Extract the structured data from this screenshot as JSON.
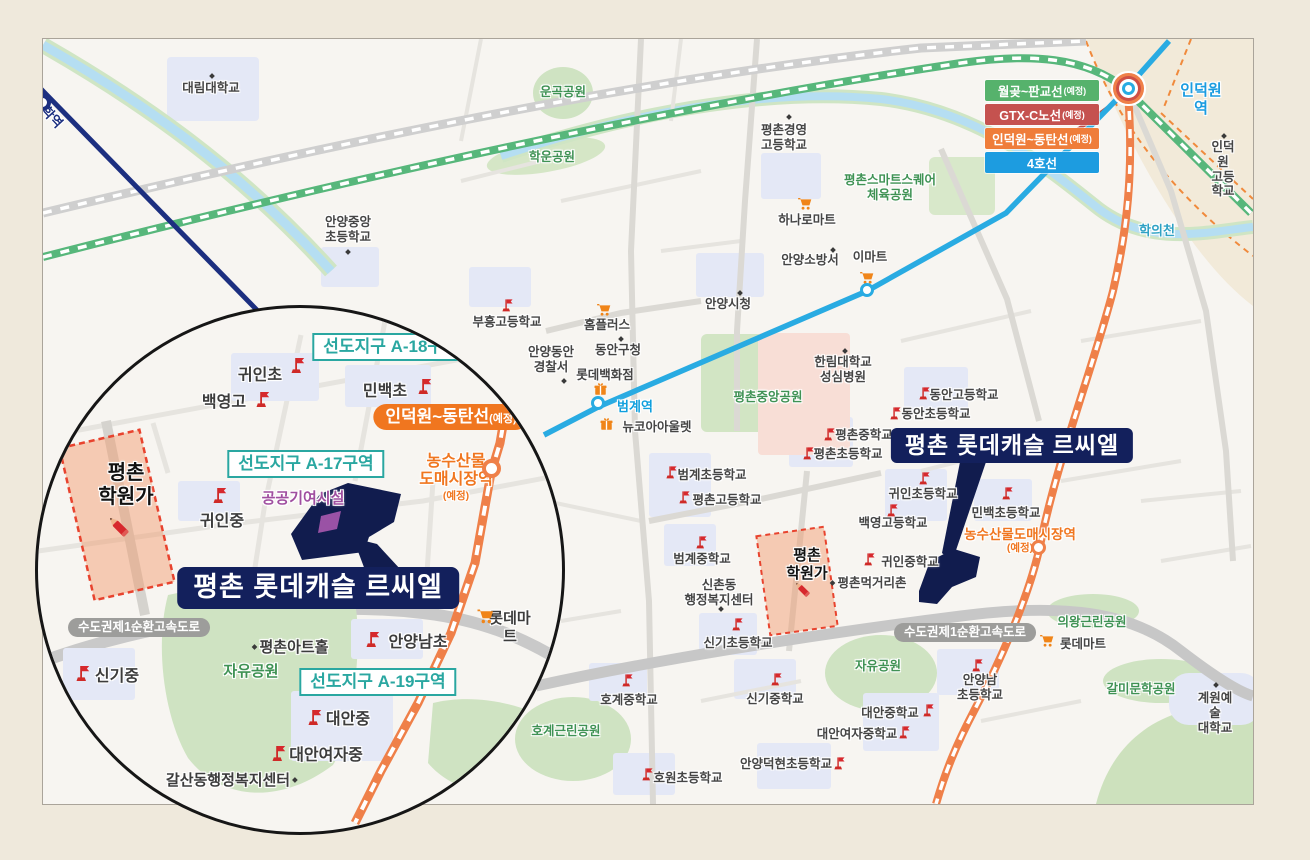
{
  "project": {
    "name": "평촌 롯데캐슬 르씨엘"
  },
  "legend": {
    "items": [
      {
        "id": "line-wolgot-pangyo",
        "label": "월곶~판교선",
        "note": "(예정)",
        "color": "#56b26c"
      },
      {
        "id": "line-gtx-c",
        "label": "GTX-C노선",
        "note": "(예정)",
        "color": "#c5524f"
      },
      {
        "id": "line-indeogwon-dongtan",
        "label": "인덕원~동탄선",
        "note": "(예정)",
        "color": "#ef7d3a"
      },
      {
        "id": "line-4",
        "label": "4호선",
        "note": "",
        "color": "#1d9ce0"
      }
    ]
  },
  "colors": {
    "line4_cyan": "#29abe2",
    "line1_navy": "#1c2f80",
    "rail_green": "#57b77b",
    "rail_orange": "#ef8049",
    "gtx_red": "#bd4d49",
    "park_green_text": "#3f9254",
    "teal_district": "#2aa7a1",
    "orange_planned": "#f0761f",
    "navy_label": "#13205c",
    "school_flag_red": "#d7282d",
    "hakwon_dashed_red": "#e8432e",
    "purple_facility": "#a04fa0"
  },
  "icon_names": [
    "school-flag-icon",
    "mart-cart-icon",
    "department-gift-icon",
    "hakwon-pencil-icon",
    "poi-dot-icon",
    "station-marker"
  ],
  "map_labels": [
    {
      "id": "daelim-univ",
      "layer": "m",
      "cls": "g",
      "x": 210,
      "y": 80,
      "text": "대림대학교"
    },
    {
      "id": "anyang-jungang-elem",
      "layer": "m",
      "cls": "g",
      "x": 347,
      "y": 214,
      "text": "안양중앙",
      "text2": "초등학교"
    },
    {
      "id": "myeonghak-station",
      "layer": "m",
      "cls": "navyrot",
      "x": 47,
      "y": 104,
      "text": "명학역"
    },
    {
      "id": "ungok-park",
      "layer": "m",
      "cls": "park",
      "x": 562,
      "y": 84,
      "text": "운곡공원"
    },
    {
      "id": "hakun-park",
      "layer": "m",
      "cls": "park",
      "x": 551,
      "y": 149,
      "text": "학운공원"
    },
    {
      "id": "pc-gyeongyeong-high",
      "layer": "m",
      "cls": "g",
      "x": 783,
      "y": 122,
      "text": "평촌경영",
      "text2": "고등학교"
    },
    {
      "id": "pc-smartsquare-park",
      "layer": "m",
      "cls": "park",
      "x": 889,
      "y": 172,
      "text": "평촌스마트스퀘어",
      "text2": "체육공원"
    },
    {
      "id": "hanaro-mart",
      "layer": "m",
      "cls": "g",
      "x": 806,
      "y": 212,
      "text": "하나로마트"
    },
    {
      "id": "anyang-fire-station",
      "layer": "m",
      "cls": "g",
      "x": 809,
      "y": 252,
      "text": "안양소방서"
    },
    {
      "id": "emart",
      "layer": "m",
      "cls": "g",
      "x": 869,
      "y": 249,
      "text": "이마트"
    },
    {
      "id": "anyang-cityhall",
      "layer": "m",
      "cls": "g",
      "x": 727,
      "y": 296,
      "text": "안양시청"
    },
    {
      "id": "homeplus",
      "layer": "m",
      "cls": "g",
      "x": 606,
      "y": 317,
      "text": "홈플러스"
    },
    {
      "id": "dongan-guoffice",
      "layer": "m",
      "cls": "g",
      "x": 617,
      "y": 342,
      "text": "동안구청"
    },
    {
      "id": "anyang-dongan-police",
      "layer": "m",
      "cls": "g",
      "x": 550,
      "y": 344,
      "text": "안양동안",
      "text2": "경찰서"
    },
    {
      "id": "lotte-dept",
      "layer": "m",
      "cls": "g",
      "x": 604,
      "y": 367,
      "text": "롯데백화점"
    },
    {
      "id": "beomgye-station-label",
      "layer": "m",
      "cls": "cyan",
      "x": 634,
      "y": 398,
      "text": "범계역"
    },
    {
      "id": "newcore-outlet",
      "layer": "m",
      "cls": "g",
      "x": 656,
      "y": 419,
      "text": "뉴코아아울렛"
    },
    {
      "id": "hallym-hospital",
      "layer": "m",
      "cls": "g",
      "x": 842,
      "y": 354,
      "text": "한림대학교",
      "text2": "성심병원"
    },
    {
      "id": "pc-central-park",
      "layer": "m",
      "cls": "park",
      "x": 767,
      "y": 389,
      "text": "평촌중앙공원"
    },
    {
      "id": "buheung-high",
      "layer": "m",
      "cls": "g",
      "x": 506,
      "y": 314,
      "text": "부흥고등학교"
    },
    {
      "id": "dongan-high",
      "layer": "m",
      "cls": "g",
      "x": 963,
      "y": 387,
      "text": "동안고등학교"
    },
    {
      "id": "dongan-elem",
      "layer": "m",
      "cls": "g",
      "x": 935,
      "y": 406,
      "text": "동안초등학교"
    },
    {
      "id": "pyeongchon-middle",
      "layer": "m",
      "cls": "g",
      "x": 863,
      "y": 427,
      "text": "평촌중학교"
    },
    {
      "id": "pyeongchon-elem",
      "layer": "m",
      "cls": "g",
      "x": 847,
      "y": 446,
      "text": "평촌초등학교"
    },
    {
      "id": "guin-elem-main",
      "layer": "m",
      "cls": "g",
      "x": 922,
      "y": 486,
      "text": "귀인초등학교"
    },
    {
      "id": "minbaek-elem-main",
      "layer": "m",
      "cls": "g",
      "x": 1005,
      "y": 505,
      "text": "민백초등학교"
    },
    {
      "id": "baekyeong-high-main",
      "layer": "m",
      "cls": "g",
      "x": 892,
      "y": 515,
      "text": "백영고등학교"
    },
    {
      "id": "guin-middle-main",
      "layer": "m",
      "cls": "g",
      "x": 909,
      "y": 554,
      "text": "귀인중학교"
    },
    {
      "id": "pc-meokgeori",
      "layer": "m",
      "cls": "g",
      "x": 866,
      "y": 575,
      "text": "평촌먹거리촌",
      "dot": "l"
    },
    {
      "id": "beomgye-elem",
      "layer": "m",
      "cls": "g",
      "x": 711,
      "y": 467,
      "text": "범계초등학교"
    },
    {
      "id": "pyeongchon-high",
      "layer": "m",
      "cls": "g",
      "x": 726,
      "y": 492,
      "text": "평촌고등학교"
    },
    {
      "id": "beomgye-middle",
      "layer": "m",
      "cls": "g",
      "x": 701,
      "y": 551,
      "text": "범계중학교"
    },
    {
      "id": "sinchon-center",
      "layer": "m",
      "cls": "g",
      "x": 718,
      "y": 577,
      "text": "신촌동",
      "text2": "행정복지센터"
    },
    {
      "id": "singi-elem",
      "layer": "m",
      "cls": "g",
      "x": 737,
      "y": 635,
      "text": "신기초등학교"
    },
    {
      "id": "hakwonga-main",
      "layer": "m",
      "cls": "hakwon",
      "x": 806,
      "y": 546,
      "text": "평촌",
      "text2": "학원가"
    },
    {
      "id": "hogye-middle",
      "layer": "m",
      "cls": "g",
      "x": 628,
      "y": 692,
      "text": "호계중학교"
    },
    {
      "id": "hogye-park",
      "layer": "m",
      "cls": "park",
      "x": 565,
      "y": 723,
      "text": "호계근린공원"
    },
    {
      "id": "singi-middle-main",
      "layer": "m",
      "cls": "g",
      "x": 774,
      "y": 691,
      "text": "신기중학교"
    },
    {
      "id": "jayu-park-main",
      "layer": "m",
      "cls": "park",
      "x": 877,
      "y": 658,
      "text": "자유공원"
    },
    {
      "id": "daean-middle-main",
      "layer": "m",
      "cls": "g",
      "x": 889,
      "y": 705,
      "text": "대안중학교"
    },
    {
      "id": "daean-girls-main",
      "layer": "m",
      "cls": "g",
      "x": 856,
      "y": 726,
      "text": "대안여자중학교"
    },
    {
      "id": "anyangnam-elem-main",
      "layer": "m",
      "cls": "g",
      "x": 979,
      "y": 672,
      "text": "안양남",
      "text2": "초등학교"
    },
    {
      "id": "anyang-deokhyeon-elem",
      "layer": "m",
      "cls": "g",
      "x": 785,
      "y": 756,
      "text": "안양덕현초등학교"
    },
    {
      "id": "howon-elem",
      "layer": "m",
      "cls": "g",
      "x": 687,
      "y": 770,
      "text": "호원초등학교"
    },
    {
      "id": "uiwang-park",
      "layer": "m",
      "cls": "park",
      "x": 1091,
      "y": 614,
      "text": "의왕근린공원"
    },
    {
      "id": "lottemart-main",
      "layer": "m",
      "cls": "g",
      "x": 1082,
      "y": 636,
      "text": "롯데마트"
    },
    {
      "id": "galmi-park",
      "layer": "m",
      "cls": "park",
      "x": 1140,
      "y": 681,
      "text": "갈미문학공원"
    },
    {
      "id": "kaywon-univ",
      "layer": "m",
      "cls": "g",
      "x": 1214,
      "y": 690,
      "text": "계원예술",
      "text2": "대학교"
    },
    {
      "id": "ring-expressway-main",
      "layer": "m",
      "cls": "pill",
      "x": 964,
      "y": 622,
      "text": "수도권제1순환고속도로"
    },
    {
      "id": "hakuicheon",
      "layer": "m",
      "cls": "stream",
      "x": 1156,
      "y": 222,
      "text": "학의천"
    },
    {
      "id": "indeogwon-station-label",
      "layer": "m",
      "cls": "cyanb",
      "x": 1200,
      "y": 81,
      "text": "인덕원역"
    },
    {
      "id": "indeogwon-high",
      "layer": "m",
      "cls": "g",
      "x": 1222,
      "y": 139,
      "text": "인덕원",
      "text2": "고등학교"
    },
    {
      "id": "nongsusanmul-station-main",
      "layer": "m",
      "cls": "orangeT",
      "x": 1019,
      "y": 526,
      "text": "농수산물도매시장역"
    },
    {
      "id": "nongsusanmul-note-main",
      "layer": "m",
      "cls": "orangeS",
      "x": 1019,
      "y": 541,
      "text": "(예정)"
    },
    {
      "id": "project-label-main",
      "layer": "m",
      "cls": "navybox",
      "x": 1011,
      "y": 427,
      "text": "평촌 롯데캐슬 르씨엘"
    },
    {
      "id": "district-a18",
      "layer": "i",
      "cls": "tealbox",
      "x": 388,
      "y": 330,
      "text": "선도지구 A-18구역"
    },
    {
      "id": "guin-elem-inset",
      "layer": "i",
      "cls": "schoolb",
      "x": 257,
      "y": 364,
      "text": "귀인초"
    },
    {
      "id": "baekyeong-high-inset",
      "layer": "i",
      "cls": "schoolb",
      "x": 221,
      "y": 391,
      "text": "백영고"
    },
    {
      "id": "minbaek-elem-inset",
      "layer": "i",
      "cls": "schoolb",
      "x": 382,
      "y": 380,
      "text": "민백초"
    },
    {
      "id": "indeogwon-dongtan-pill",
      "layer": "i",
      "cls": "orangepill",
      "x": 448,
      "y": 401,
      "text": "인덕원~동탄선",
      "note": "(예정)"
    },
    {
      "id": "district-a17",
      "layer": "i",
      "cls": "tealbox",
      "x": 303,
      "y": 447,
      "text": "선도지구 A-17구역"
    },
    {
      "id": "public-facility",
      "layer": "i",
      "cls": "purple",
      "x": 300,
      "y": 487,
      "text": "공공기여시설"
    },
    {
      "id": "guin-middle-inset",
      "layer": "i",
      "cls": "schoolb",
      "x": 219,
      "y": 510,
      "text": "귀인중"
    },
    {
      "id": "nongsusanmul-station-inset",
      "layer": "i",
      "cls": "orangeB",
      "x": 453,
      "y": 450,
      "text": "농수산물",
      "text2": "도매시장역"
    },
    {
      "id": "nongsusanmul-note-inset",
      "layer": "i",
      "cls": "orangeS",
      "x": 453,
      "y": 487,
      "text": "(예정)"
    },
    {
      "id": "hakwonga-inset",
      "layer": "i",
      "cls": "hakwonb",
      "x": 123,
      "y": 458,
      "text": "평촌",
      "text2": "학원가"
    },
    {
      "id": "project-label-inset",
      "layer": "i",
      "cls": "navybox2",
      "x": 315,
      "y": 564,
      "text": "평촌 롯데캐슬 르씨엘"
    },
    {
      "id": "ring-expressway-inset",
      "layer": "i",
      "cls": "pill",
      "x": 136,
      "y": 615,
      "text": "수도권제1순환고속도로"
    },
    {
      "id": "pc-arthall",
      "layer": "i",
      "cls": "insetg",
      "x": 286,
      "y": 636,
      "text": "평촌아트홀",
      "dot": "l"
    },
    {
      "id": "jayu-park-inset",
      "layer": "i",
      "cls": "parkb",
      "x": 248,
      "y": 660,
      "text": "자유공원"
    },
    {
      "id": "anyangnam-elem-inset",
      "layer": "i",
      "cls": "schoolb",
      "x": 415,
      "y": 631,
      "text": "안양남초"
    },
    {
      "id": "district-a19",
      "layer": "i",
      "cls": "tealbox",
      "x": 375,
      "y": 665,
      "text": "선도지구 A-19구역"
    },
    {
      "id": "daean-middle-inset",
      "layer": "i",
      "cls": "schoolb",
      "x": 345,
      "y": 708,
      "text": "대안중"
    },
    {
      "id": "daean-girls-inset",
      "layer": "i",
      "cls": "schoolb",
      "x": 323,
      "y": 744,
      "text": "대안여자중"
    },
    {
      "id": "galsan-center",
      "layer": "i",
      "cls": "insetg",
      "x": 230,
      "y": 769,
      "text": "갈산동행정복지센터",
      "dot": "r"
    },
    {
      "id": "singi-middle-inset",
      "layer": "i",
      "cls": "schoolb",
      "x": 114,
      "y": 665,
      "text": "신기중"
    },
    {
      "id": "lottemart-inset",
      "layer": "i",
      "cls": "insetg",
      "x": 507,
      "y": 607,
      "text": "롯데마트"
    }
  ],
  "icons": [
    {
      "type": "flag",
      "layer": "m",
      "x": 497,
      "y": 296
    },
    {
      "type": "flag",
      "layer": "m",
      "x": 914,
      "y": 384
    },
    {
      "type": "flag",
      "layer": "m",
      "x": 885,
      "y": 404
    },
    {
      "type": "flag",
      "layer": "m",
      "x": 819,
      "y": 425
    },
    {
      "type": "flag",
      "layer": "m",
      "x": 798,
      "y": 444
    },
    {
      "type": "flag",
      "layer": "m",
      "x": 914,
      "y": 469
    },
    {
      "type": "flag",
      "layer": "m",
      "x": 997,
      "y": 484
    },
    {
      "type": "flag",
      "layer": "m",
      "x": 882,
      "y": 501
    },
    {
      "type": "flag",
      "layer": "m",
      "x": 859,
      "y": 550
    },
    {
      "type": "flag",
      "layer": "m",
      "x": 661,
      "y": 463
    },
    {
      "type": "flag",
      "layer": "m",
      "x": 674,
      "y": 488
    },
    {
      "type": "flag",
      "layer": "m",
      "x": 691,
      "y": 533
    },
    {
      "type": "flag",
      "layer": "m",
      "x": 727,
      "y": 615
    },
    {
      "type": "flag",
      "layer": "m",
      "x": 617,
      "y": 671
    },
    {
      "type": "flag",
      "layer": "m",
      "x": 766,
      "y": 670
    },
    {
      "type": "flag",
      "layer": "m",
      "x": 918,
      "y": 701
    },
    {
      "type": "flag",
      "layer": "m",
      "x": 894,
      "y": 723
    },
    {
      "type": "flag",
      "layer": "m",
      "x": 967,
      "y": 656
    },
    {
      "type": "flag",
      "layer": "m",
      "x": 829,
      "y": 754
    },
    {
      "type": "flag",
      "layer": "m",
      "x": 637,
      "y": 765
    },
    {
      "type": "flagb",
      "layer": "i",
      "x": 283,
      "y": 352
    },
    {
      "type": "flagb",
      "layer": "i",
      "x": 248,
      "y": 386
    },
    {
      "type": "flagb",
      "layer": "i",
      "x": 410,
      "y": 373
    },
    {
      "type": "flagb",
      "layer": "i",
      "x": 205,
      "y": 482
    },
    {
      "type": "flagb",
      "layer": "i",
      "x": 358,
      "y": 626
    },
    {
      "type": "flagb",
      "layer": "i",
      "x": 300,
      "y": 704
    },
    {
      "type": "flagb",
      "layer": "i",
      "x": 264,
      "y": 740
    },
    {
      "type": "flagb",
      "layer": "i",
      "x": 68,
      "y": 660
    },
    {
      "type": "cart",
      "layer": "m",
      "x": 795,
      "y": 194
    },
    {
      "type": "cart",
      "layer": "m",
      "x": 857,
      "y": 268
    },
    {
      "type": "cart",
      "layer": "m",
      "x": 594,
      "y": 300
    },
    {
      "type": "cart",
      "layer": "m",
      "x": 1037,
      "y": 631
    },
    {
      "type": "cartb",
      "layer": "i",
      "x": 472,
      "y": 603
    },
    {
      "type": "gift",
      "layer": "m",
      "x": 592,
      "y": 381
    },
    {
      "type": "gift",
      "layer": "m",
      "x": 598,
      "y": 416
    },
    {
      "type": "pencil",
      "layer": "m",
      "x": 790,
      "y": 577
    },
    {
      "type": "pencilb",
      "layer": "i",
      "x": 100,
      "y": 508
    },
    {
      "type": "dot",
      "layer": "m",
      "x": 209,
      "y": 73
    },
    {
      "type": "dot",
      "layer": "m",
      "x": 345,
      "y": 249
    },
    {
      "type": "dot",
      "layer": "m",
      "x": 786,
      "y": 114
    },
    {
      "type": "dot",
      "layer": "m",
      "x": 830,
      "y": 247
    },
    {
      "type": "dot",
      "layer": "m",
      "x": 737,
      "y": 290
    },
    {
      "type": "dot",
      "layer": "m",
      "x": 618,
      "y": 336
    },
    {
      "type": "dot",
      "layer": "m",
      "x": 561,
      "y": 378
    },
    {
      "type": "dot",
      "layer": "m",
      "x": 842,
      "y": 348
    },
    {
      "type": "dot",
      "layer": "m",
      "x": 718,
      "y": 606
    },
    {
      "type": "dot",
      "layer": "m",
      "x": 1213,
      "y": 682
    },
    {
      "type": "dot",
      "layer": "m",
      "x": 1221,
      "y": 133
    }
  ],
  "stations": [
    {
      "id": "beomgye-station-marker",
      "layer": "m",
      "cls": "st-cyan",
      "x": 590,
      "y": 395
    },
    {
      "id": "pyeongchon-station-marker",
      "layer": "m",
      "cls": "st-cyan",
      "x": 859,
      "y": 282
    },
    {
      "id": "nongsusanmul-station-marker-main",
      "layer": "m",
      "cls": "st-orange",
      "x": 1030,
      "y": 539
    },
    {
      "id": "indeogwon-station-marker",
      "layer": "m",
      "cls": "st-multi",
      "x": 1121,
      "y": 81
    },
    {
      "id": "myeonghak-station-marker",
      "layer": "m",
      "cls": "st-navy",
      "x": 33,
      "y": 93
    },
    {
      "id": "nongsusanmul-station-marker-inset",
      "layer": "i",
      "cls": "st-orangeb",
      "x": 479,
      "y": 456
    }
  ]
}
